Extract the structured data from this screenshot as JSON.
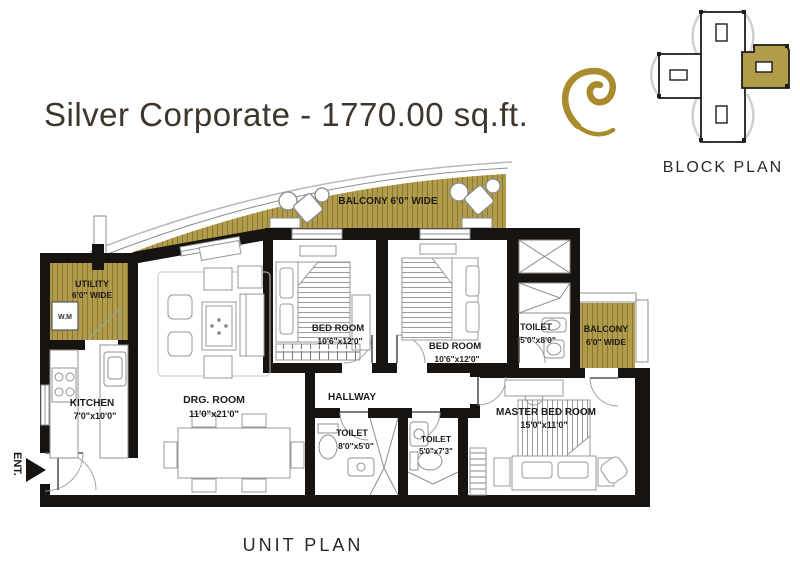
{
  "header": {
    "title": "Silver Corporate - 1770.00 sq.ft."
  },
  "block_plan": {
    "label": "BLOCK PLAN"
  },
  "unit_plan": {
    "label": "UNIT PLAN"
  },
  "rooms": {
    "balcony_top": {
      "name": "BALCONY  6'0\" WIDE"
    },
    "utility": {
      "name": "UTILITY",
      "dims": "6'0\" WIDE"
    },
    "kitchen": {
      "name": "KITCHEN",
      "dims": "7'0\"x10'0\""
    },
    "drg_room": {
      "name": "DRG. ROOM",
      "dims": "11'0\"x21'0\""
    },
    "bed_room_1": {
      "name": "BED ROOM",
      "dims": "10'6\"x12'0\""
    },
    "bed_room_2": {
      "name": "BED ROOM",
      "dims": "10'6\"x12'0\""
    },
    "toilet_1": {
      "name": "TOILET",
      "dims": "5'0\"x8'0\""
    },
    "balcony_right": {
      "name": "BALCONY",
      "dims": "6'0\" WIDE"
    },
    "hallway": {
      "name": "HALLWAY"
    },
    "toilet_2": {
      "name": "TOILET",
      "dims": "8'0\"x5'0\""
    },
    "toilet_3": {
      "name": "TOILET",
      "dims": "5'0\"x7'3\""
    },
    "master_bed_room": {
      "name": "MASTER BED ROOM",
      "dims": "15'0\"x11'0\""
    },
    "entrance": {
      "label": "ENT."
    },
    "washing_machine": {
      "label": "W.M"
    }
  },
  "colors": {
    "gold": "#b19c4b",
    "hatch": "#8b7832",
    "wall": "#161310",
    "title": "#3e352b",
    "label": "#1e1b17"
  }
}
